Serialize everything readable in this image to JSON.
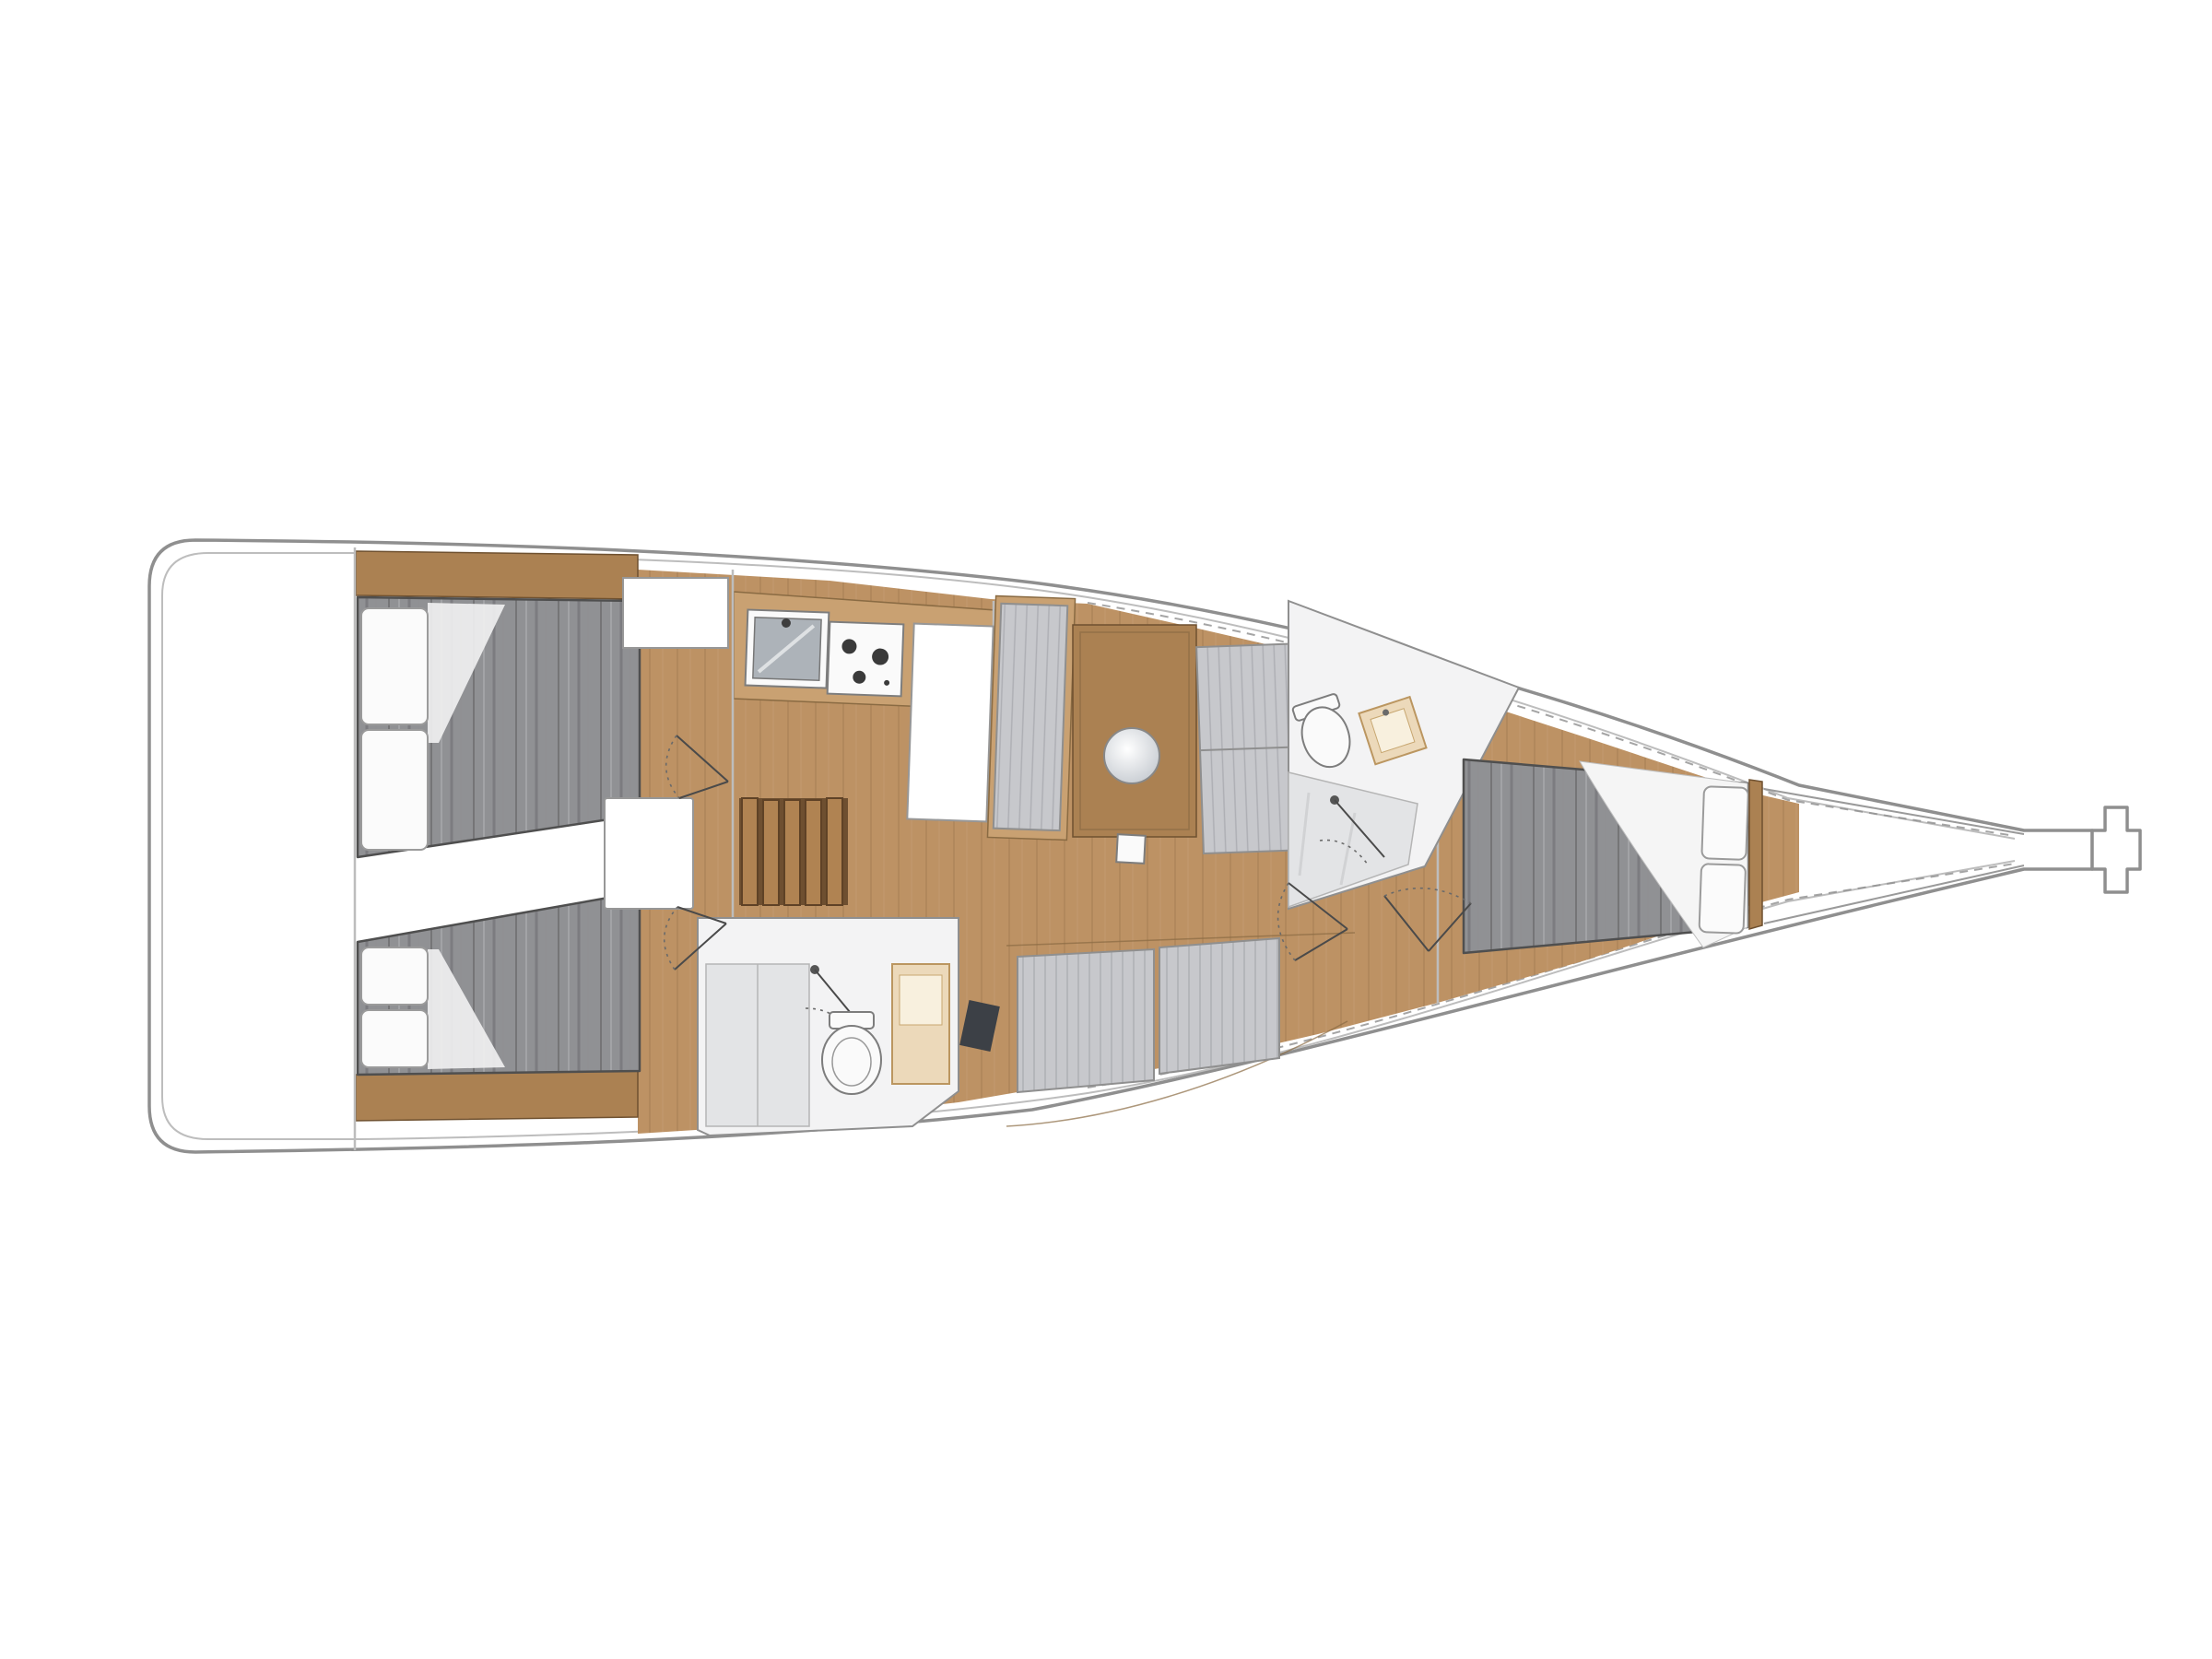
{
  "diagram": {
    "label": "Sailboat interior layout floor plan, stern at left, bow pointing right",
    "type": "yacht-floor-plan",
    "cabins_count": 3,
    "heads_count": 2
  },
  "colors": {
    "canvas": "#ffffff",
    "hull_line": "#8f8f8f",
    "liner_line": "#bdbdbd",
    "detail_line": "#4f4f4f",
    "wood": "#bd9264",
    "wood_light": "#c9a172",
    "wood_dark": "#ab8152",
    "duvet": "#909194",
    "cushion": "#c7c8cc",
    "pillow": "#fbfbfb",
    "bath_floor": "#f3f3f4",
    "shower_gray": "#e3e4e6",
    "fixture_white": "#fafafa",
    "basin_gray": "#adb3b9",
    "sink_beige": "#ecd9ba",
    "sink_beige_stroke": "#bb9660",
    "dark_item": "#3c4046",
    "step_wood": "#b08352",
    "step_gap": "#6e4f30",
    "step_stroke": "#5f4226",
    "engine_white": "#ffffff"
  },
  "components": [
    "hull",
    "stern-platform",
    "aft-cabin-starboard",
    "aft-cabin-port",
    "double-berth-starboard",
    "double-berth-port",
    "pillows",
    "headboard-shelves",
    "companionway-steps",
    "engine-box",
    "galley-counter",
    "galley-sink",
    "galley-stove",
    "storage-locker",
    "chart-table",
    "nav-seat",
    "saloon-table",
    "table-inlay",
    "mast-step",
    "settee-starboard",
    "settee-port",
    "aft-head",
    "aft-shower",
    "aft-toilet",
    "aft-washbasin",
    "forward-head",
    "forward-toilet",
    "forward-washbasin",
    "forward-shower",
    "forward-cabin",
    "v-berth",
    "anchor-locker",
    "bow-fitting",
    "cabin-doors"
  ]
}
